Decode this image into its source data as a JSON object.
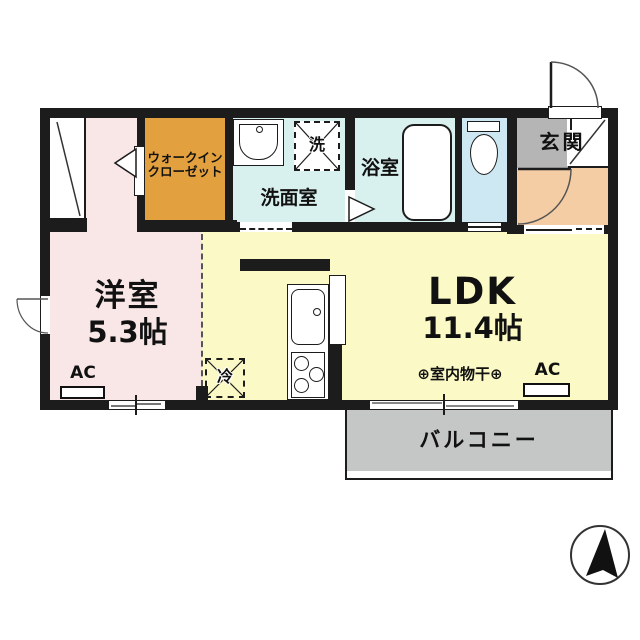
{
  "plan_title": "1LDK floor plan",
  "rooms": {
    "bedroom": {
      "name": "洋室",
      "size": "5.3帖"
    },
    "wic": {
      "name_line1": "ウォークイン",
      "name_line2": "クローゼット"
    },
    "washroom": {
      "name": "洗面室"
    },
    "bath": {
      "name": "浴室"
    },
    "entrance": {
      "name": "玄関"
    },
    "ldk": {
      "name": "LDK",
      "size": "11.4帖"
    },
    "balcony": {
      "name": "バルコニー"
    }
  },
  "labels": {
    "laundry": "洗",
    "fridge": "冷",
    "indoor_drying": "⊕室内物干⊕",
    "ac": "AC"
  },
  "colors": {
    "wall": "#1c1c1c",
    "bedroom": "#f9e7e7",
    "wic": "#e2a03f",
    "washroom": "#d9f1ee",
    "bath": "#d9f1ee",
    "toilet": "#cde7f3",
    "entrance": "#b5b5b6",
    "hallway": "#f4cda4",
    "ldk": "#fbf9c5",
    "balcony": "#c5c6c6"
  }
}
